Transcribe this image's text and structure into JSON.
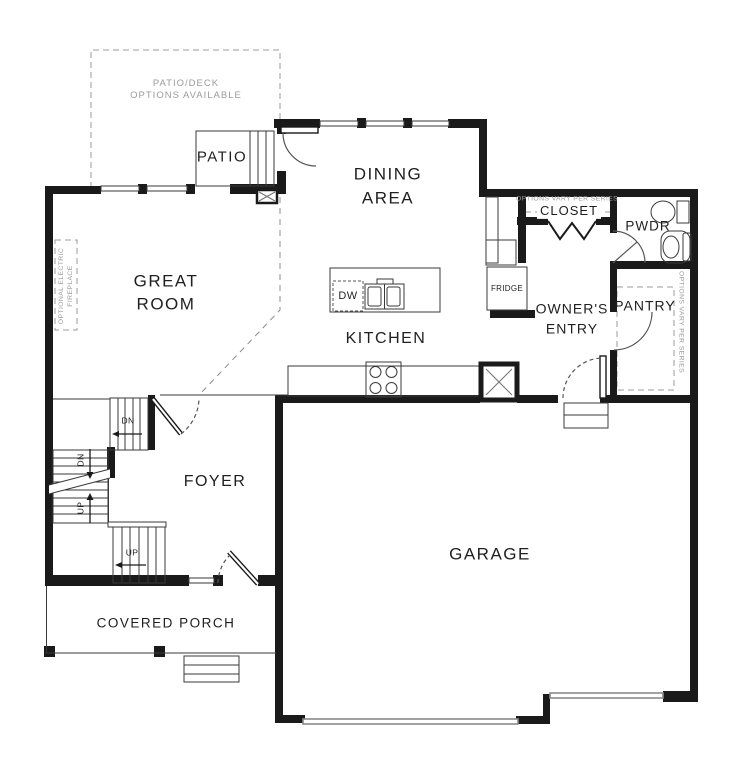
{
  "floor_plan": {
    "rooms": {
      "patio": "PATIO",
      "dining_line1": "DINING",
      "dining_line2": "AREA",
      "great_room_line1": "GREAT",
      "great_room_line2": "ROOM",
      "kitchen": "KITCHEN",
      "closet": "CLOSET",
      "powder": "PWDR",
      "owners_entry_line1": "OWNER'S",
      "owners_entry_line2": "ENTRY",
      "pantry": "PANTRY",
      "foyer": "FOYER",
      "garage": "GARAGE",
      "covered_porch": "COVERED PORCH"
    },
    "fixtures": {
      "dishwasher": "DW",
      "fridge": "FRIDGE"
    },
    "stairs": {
      "down": "DN",
      "up": "UP"
    },
    "notes": {
      "patio_deck_line1": "PATIO/DECK",
      "patio_deck_line2": "OPTIONS AVAILABLE",
      "options_vary_closet": "OPTIONS VARY PER SERIES",
      "options_vary_pantry": "OPTIONS VARY PER SERIES",
      "optional_fireplace_line1": "OPTIONAL ELECTRIC",
      "optional_fireplace_line2": "FIREPLACE"
    },
    "colors": {
      "wall": "#1a1a1a",
      "thin_line": "#3a3a3a",
      "note_gray": "#9b9b9b",
      "garage_door": "#8a8a8a",
      "background": "#ffffff"
    }
  }
}
